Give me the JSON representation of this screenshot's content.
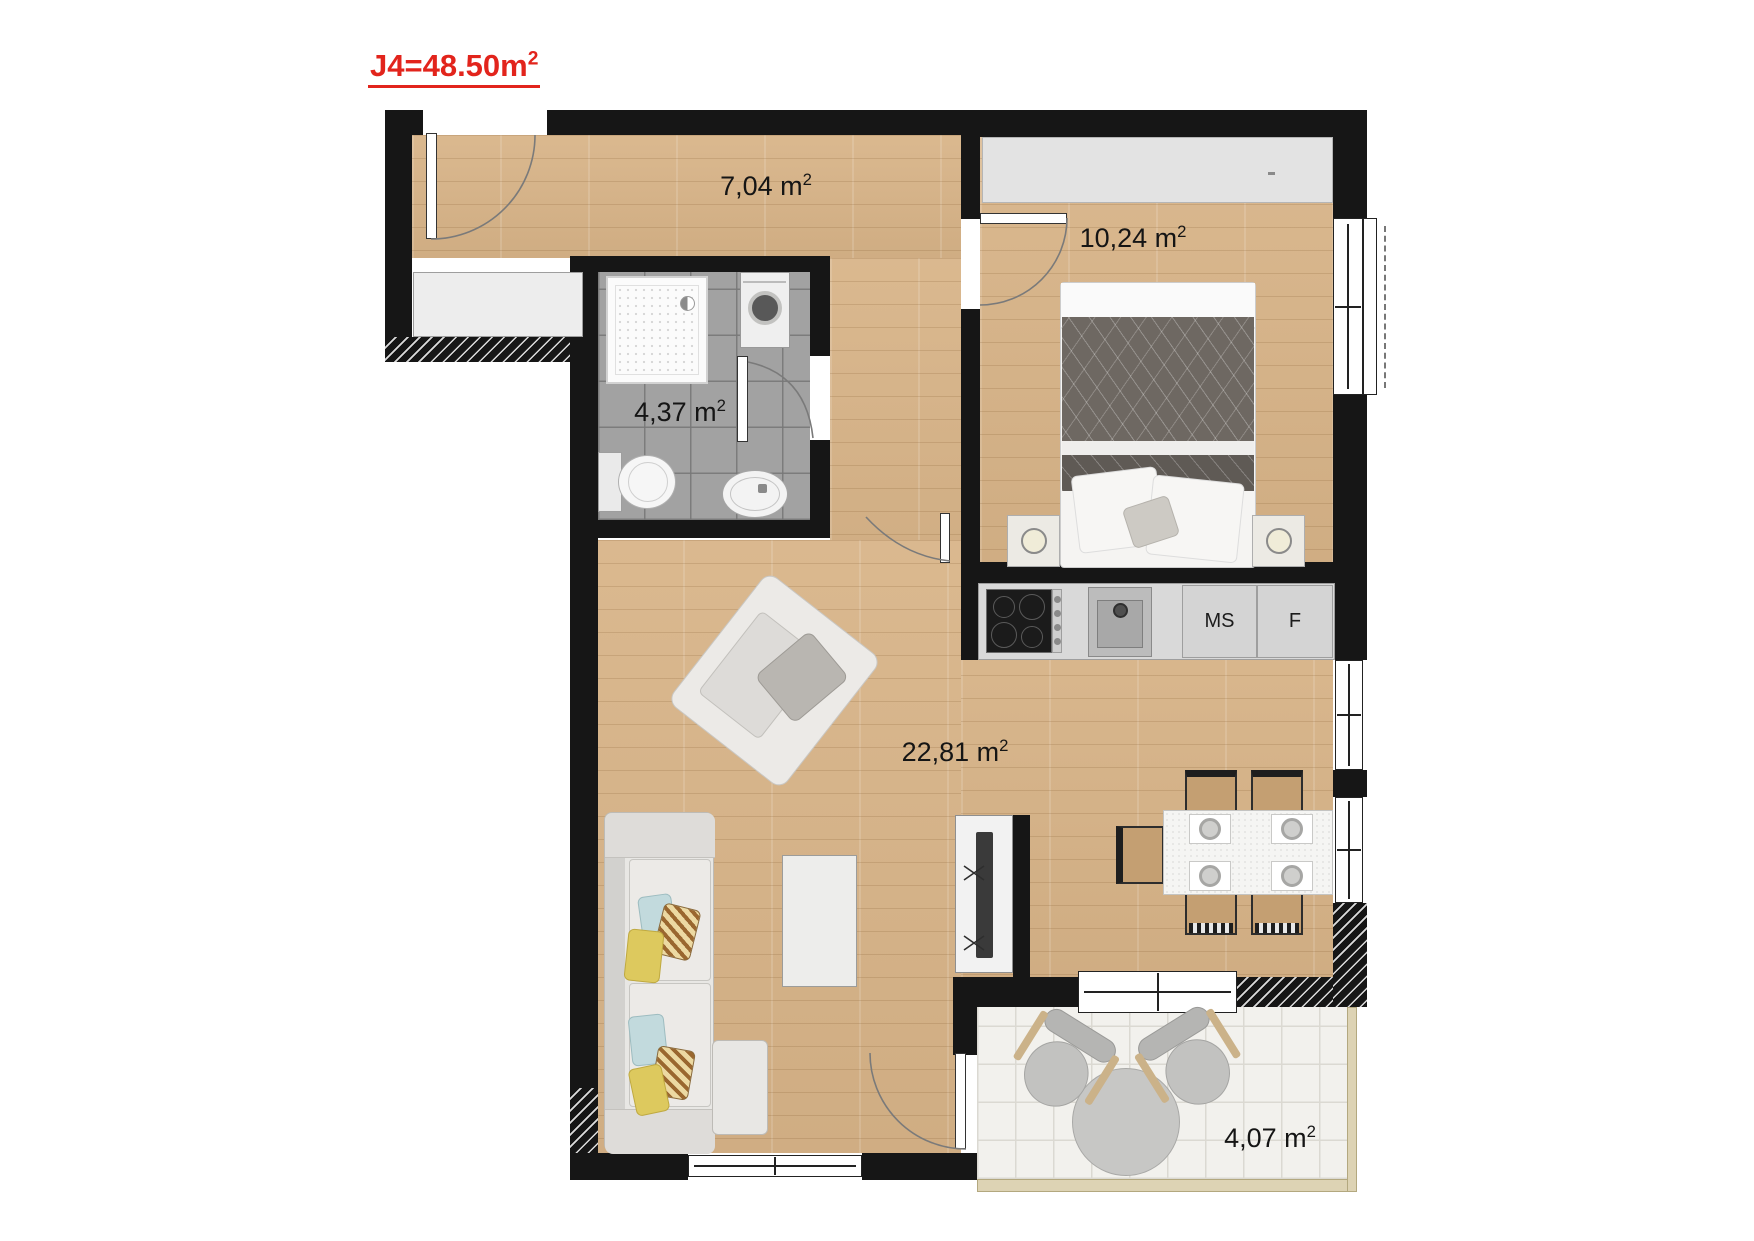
{
  "title": {
    "value": "J4=48.50m",
    "sup": "2"
  },
  "rooms": {
    "hall": {
      "area": {
        "value": "7,04 m",
        "sup": "2"
      }
    },
    "bedroom": {
      "area": {
        "value": "10,24 m",
        "sup": "2"
      }
    },
    "bathroom": {
      "area": {
        "value": "4,37 m",
        "sup": "2"
      }
    },
    "living": {
      "area": {
        "value": "22,81 m",
        "sup": "2"
      }
    },
    "balcony": {
      "area": {
        "value": "4,07 m",
        "sup": "2"
      }
    }
  },
  "kitchen": {
    "labels": {
      "ms": "MS",
      "fridge": "F"
    }
  },
  "colors": {
    "title": "#e2241c",
    "wall": "#161616",
    "wood": "#d8b488",
    "tile": "#a2a2a2",
    "counter": "#d9d9d9",
    "balcony": "#f2f1ed"
  }
}
